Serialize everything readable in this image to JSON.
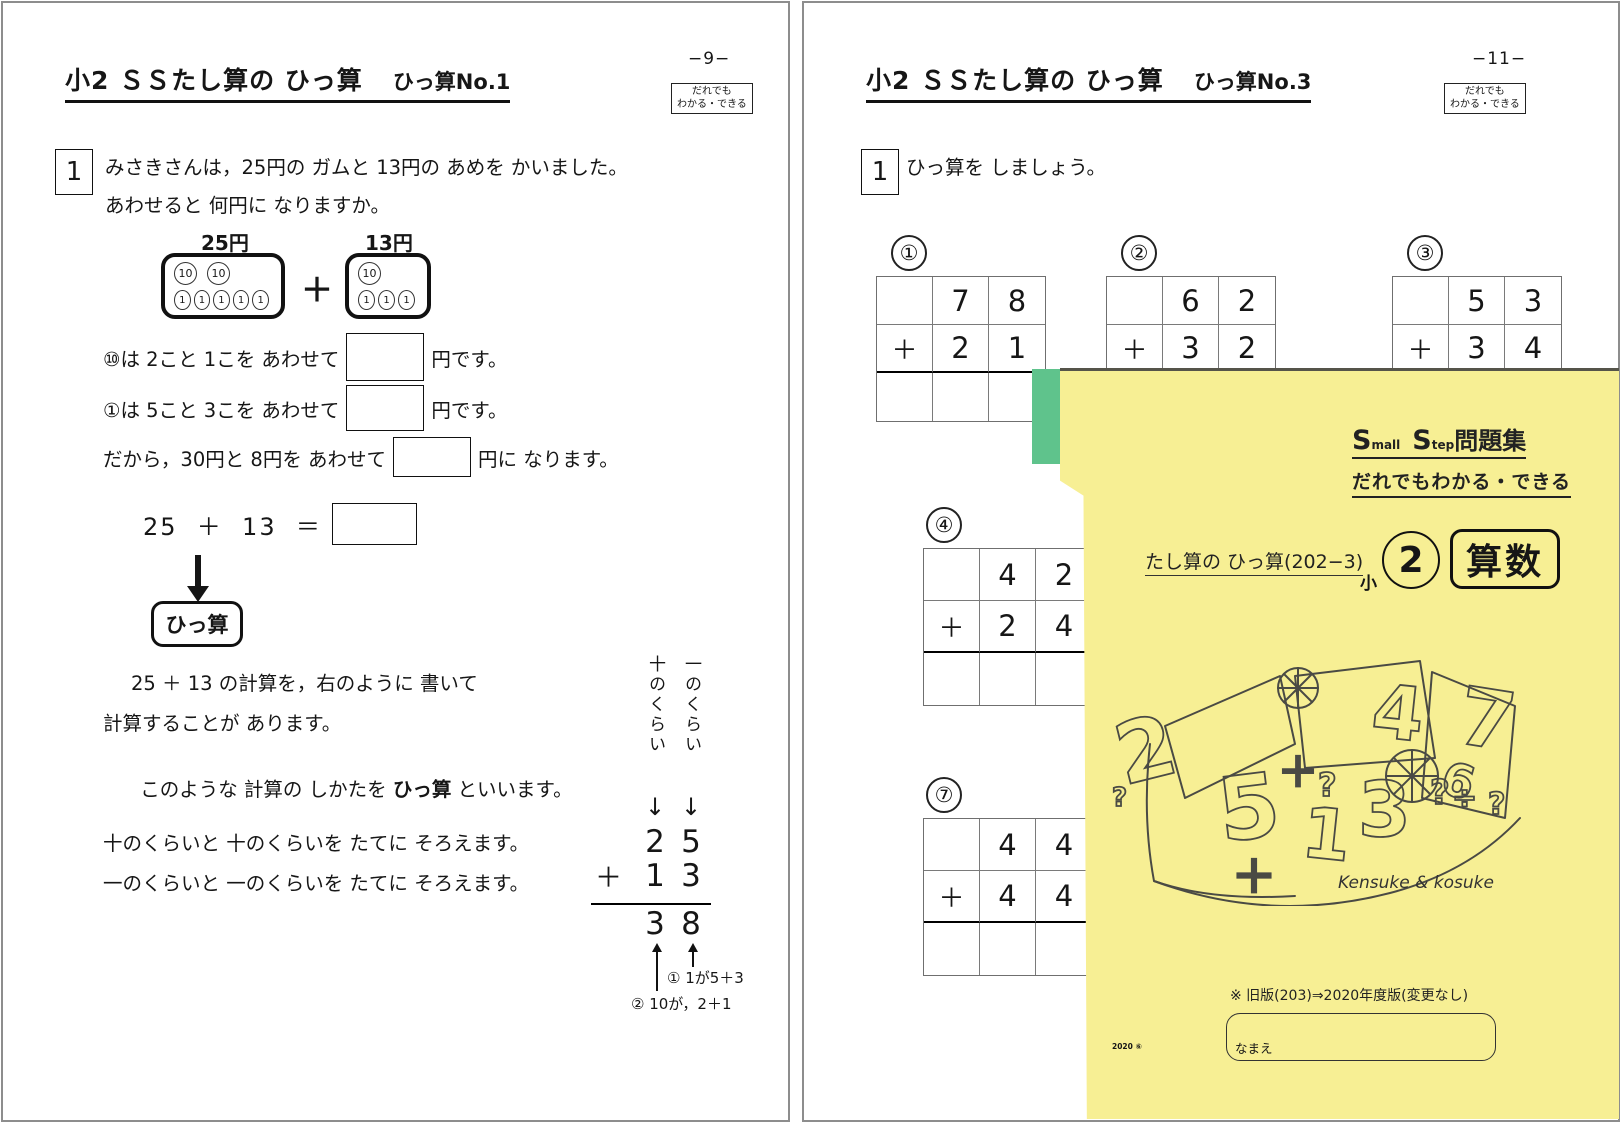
{
  "left_page": {
    "page_number": "−9−",
    "badge": {
      "line1": "だれでも",
      "line2": "わかる・できる"
    },
    "title": {
      "main": "小2 ＳＳたし算の ひっ算",
      "sub": "ひっ算No.1"
    },
    "q1": {
      "number": "1",
      "line1": "みさきさんは，25円の ガムと 13円の あめを かいました。",
      "line2": "あわせると 何円に なりますか。"
    },
    "coins": {
      "left_label": "25円",
      "right_label": "13円",
      "plus": "＋",
      "ten": "10",
      "one": "1"
    },
    "fill_lines": [
      {
        "pre": "⑩は 2こと 1こを あわせて",
        "post": "円です。"
      },
      {
        "pre": "①は 5こと 3こを あわせて",
        "post": "円です。"
      },
      {
        "pre": "だから，30円と 8円を あわせて",
        "post": "円に なります。"
      }
    ],
    "equation": "25  ＋  13  ＝",
    "hissan_box": "ひっ算",
    "para": {
      "line1": "25 ＋ 13 の計算を，右のように 書いて",
      "line2": "計算することが あります。",
      "line3_pre": "このような 計算の しかたを ",
      "line3_bold": "ひっ算",
      "line3_post": " といいます。",
      "line4": "十のくらいと 十のくらいを たてに そろえます。",
      "line5": "一のくらいと 一のくらいを たてに そろえます。"
    },
    "vcalc": {
      "tens_label": "十のくらい",
      "ones_label": "一のくらい",
      "arrow_down": "↓",
      "top_tens": "2",
      "top_ones": "5",
      "plus": "＋",
      "bot_tens": "1",
      "bot_ones": "3",
      "res_tens": "3",
      "res_ones": "8",
      "note1": "① 1が5＋3",
      "note2": "② 10が，2＋1"
    }
  },
  "right_page": {
    "page_number": "−11−",
    "badge": {
      "line1": "だれでも",
      "line2": "わかる・できる"
    },
    "title": {
      "main": "小2 ＳＳたし算の ひっ算",
      "sub": "ひっ算No.3"
    },
    "q1": {
      "number": "1",
      "text": "ひっ算を しましょう。"
    },
    "problems": [
      {
        "label": "①",
        "t1": "7",
        "t2": "8",
        "plus": "＋",
        "b1": "2",
        "b2": "1"
      },
      {
        "label": "②",
        "t1": "6",
        "t2": "2",
        "plus": "＋",
        "b1": "3",
        "b2": "2"
      },
      {
        "label": "③",
        "t1": "5",
        "t2": "3",
        "plus": "＋",
        "b1": "3",
        "b2": "4"
      },
      {
        "label": "④",
        "t1": "4",
        "t2": "2",
        "plus": "＋",
        "b1": "2",
        "b2": "4"
      },
      {
        "label": "⑦",
        "t1": "4",
        "t2": "4",
        "plus": "＋",
        "b1": "4",
        "b2": "4"
      }
    ]
  },
  "booklet": {
    "title": {
      "s1": "S",
      "small1": "mall",
      "s2": "S",
      "small2": "tep",
      "rest": "問題集"
    },
    "subtitle": "だれでもわかる・できる",
    "topic": "たし算の ひっ算(202−3)",
    "grade": {
      "prefix": "小",
      "number": "2",
      "subject": "算数"
    },
    "doodle": {
      "digits": [
        "2",
        "5",
        "1",
        "3",
        "4",
        "7",
        "6"
      ],
      "symbols": [
        "＋",
        "＋",
        "÷",
        "?",
        "?",
        "?",
        "?"
      ]
    },
    "signature": "Kensuke & kosuke",
    "note": "※ 旧版(203)⇒2020年度版(変更なし)",
    "name_label": "なまえ",
    "print_code": "2020 ⑥",
    "colors": {
      "cover": "#f7ef94",
      "tab": "#5fc38c"
    }
  }
}
